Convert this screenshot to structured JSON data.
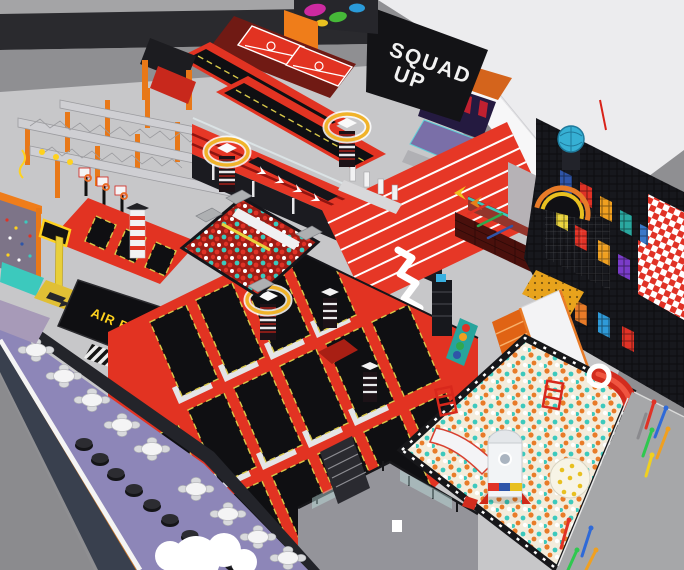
{
  "scene": {
    "description": "3D isometric render of an indoor trampoline and adventure park"
  },
  "labels": {
    "banner_line1": "SQUAD",
    "banner_line2": "UP",
    "airbag": "AIR BAG"
  },
  "colors": {
    "bg_outer": "#9a9a9b",
    "floor": "#c7c7c9",
    "floor_dark": "#8b8b8e",
    "wall_gray": "#8f8f92",
    "wall_band_dark": "#2a2a2e",
    "banner_black": "#131316",
    "banner_text": "#f2f2f2",
    "white_wall": "#ececee",
    "red": "#e23322",
    "red_dark": "#a81f14",
    "maroon": "#701a14",
    "tramp_black": "#0f0f12",
    "bed_pipe": "#d8c84a",
    "orange": "#ef7d1a",
    "yellow": "#ffd21e",
    "airbag_text": "#ffd21e",
    "purple_carpet": "#8d86b8",
    "navy_band": "#39404e",
    "teal": "#3cc9bd",
    "ball_orange": "#e87b28",
    "ball_base": "#f3ecdc",
    "track_red": "#e63726",
    "lane_white": "#ffffff",
    "checker_red": "#e03226",
    "play_blue": "#2f55a8",
    "glass": "#bfe3df",
    "cloud_white": "#ffffff"
  }
}
